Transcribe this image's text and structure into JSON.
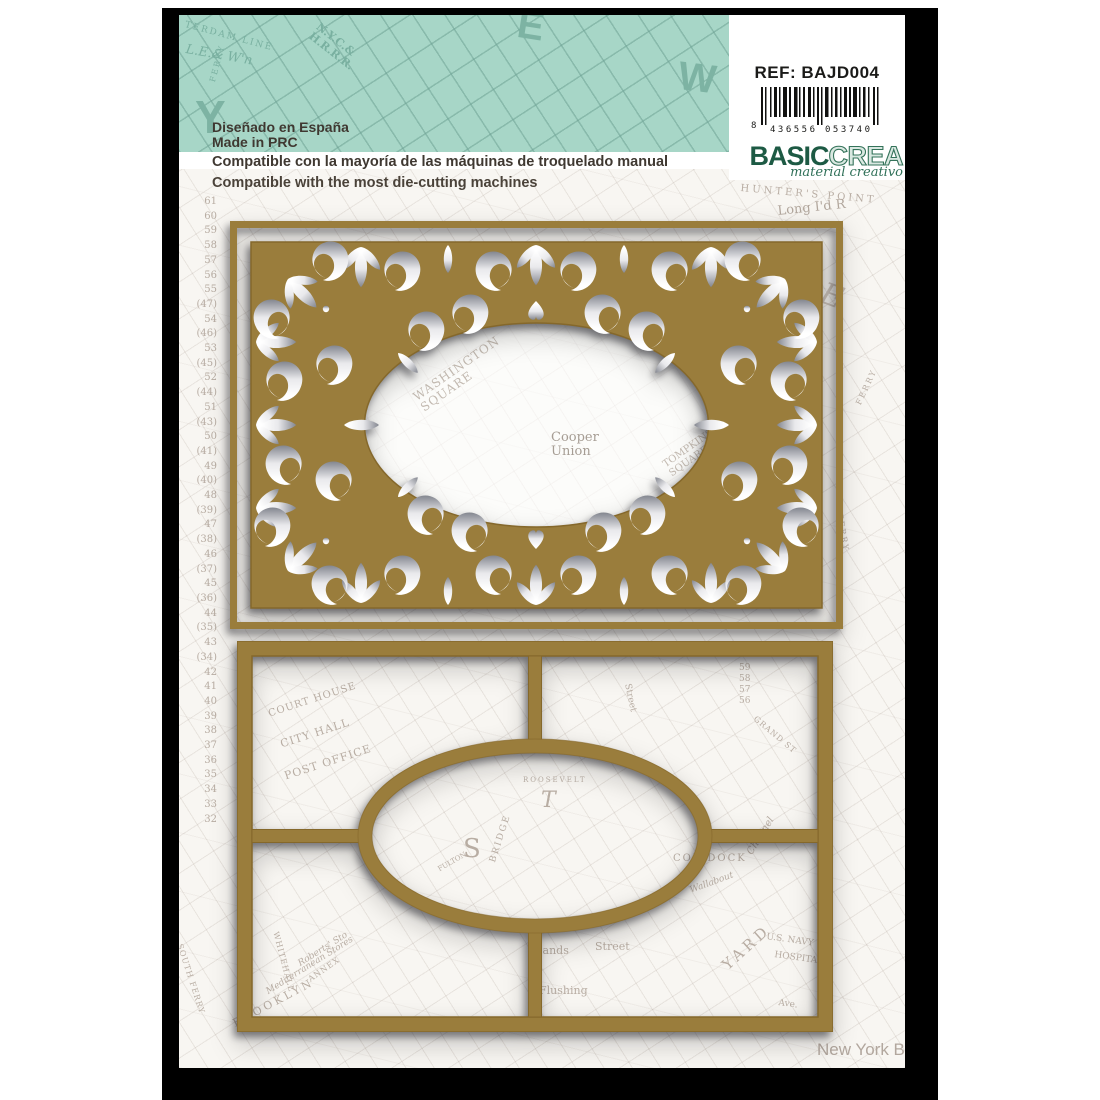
{
  "product": {
    "ref": "REF: BAJD004",
    "barcode": {
      "first": "8",
      "group1": "436556",
      "group2": "053740"
    },
    "brand": {
      "basic": "BASIC",
      "crea": "CREA",
      "tagline": "material creativo"
    },
    "origin_lines": "Diseñado en España\nMade in PRC",
    "compat_es": "Compatible con la mayoría de las máquinas de troquelado manual",
    "compat_en": "Compatible with the most die-cutting machines"
  },
  "colors": {
    "teal": "#a7d6c7",
    "gold": "#9a7d3c",
    "gold_edge": "#85682b",
    "brand_green": "#1d5a44",
    "page": "#f8f6f2",
    "backing": "#000000"
  },
  "map": {
    "pier_numbers": "61\n60\n59\n58\n57\n56\n55\n(47) 54\n(46) 53\n(45) 52\n(44) 51\n(43) 50\n(41) 49\n(40) 48\n(39) 47\n(38) 46\n(37) 45\n(36) 44\n(35) 43\n(34) 42\n41\n40\n39\n38\n37\n36\n35\n34\n33\n32",
    "teal_labels": [
      {
        "text": "TERDAM LINE"
      },
      {
        "text": "L.E.& W'n"
      },
      {
        "text": "N.Y.C.&\nH.R.R.R."
      },
      {
        "text": "Y"
      },
      {
        "text": "E"
      },
      {
        "text": "W"
      },
      {
        "text": "FERRY"
      }
    ],
    "page_labels": [
      {
        "text": "Long I'd R"
      },
      {
        "text": "E"
      },
      {
        "text": "FERRY"
      },
      {
        "text": "FERRY"
      },
      {
        "text": "HUNTER'S POINT"
      },
      {
        "text": "New York B"
      },
      {
        "text": "BROOKLYN"
      },
      {
        "text": "Mediterranean Stores"
      },
      {
        "text": "Roberts' Sto"
      },
      {
        "text": "SOUTH FERRY"
      },
      {
        "text": "WHITEHALL"
      },
      {
        "text": "ANNEX"
      }
    ],
    "oval_labels": [
      {
        "text": "WASHINGTON\nSQUARE"
      },
      {
        "text": "Cooper\nUnion"
      },
      {
        "text": "TOMPKINS\nSQUARE"
      }
    ],
    "die2_labels": [
      {
        "text": "COURT HOUSE"
      },
      {
        "text": "CITY HALL"
      },
      {
        "text": "POST OFFICE"
      },
      {
        "text": "Street"
      },
      {
        "text": "59\n58\n57\n56"
      },
      {
        "text": "GRAND ST"
      },
      {
        "text": "ROOSEVELT"
      },
      {
        "text": "T"
      },
      {
        "text": "S"
      },
      {
        "text": "BRIDGE"
      },
      {
        "text": "FULTON"
      },
      {
        "text": "COB DOCK"
      },
      {
        "text": "Channel"
      },
      {
        "text": "Wallabout"
      },
      {
        "text": "Sands"
      },
      {
        "text": "Street"
      },
      {
        "text": "Flushing"
      },
      {
        "text": "U.S. NAVY"
      },
      {
        "text": "HOSPITAL"
      },
      {
        "text": "YARD"
      },
      {
        "text": "Ave."
      }
    ]
  }
}
